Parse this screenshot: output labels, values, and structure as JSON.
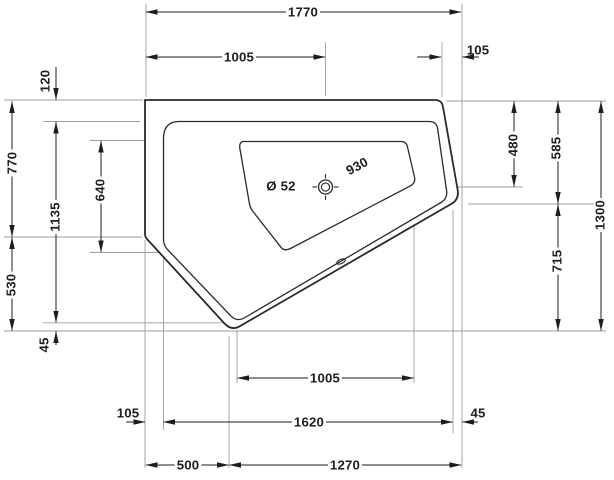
{
  "colors": {
    "line": "#1d1d1b",
    "extension": "#9d9d9d",
    "background": "#ffffff"
  },
  "dimensions": {
    "overall_width": "1770",
    "drain_from_left": "1005",
    "top_right_corner_offset": "105",
    "rim_width_top": "120",
    "left_edge_to_corner": "770",
    "inner_rim_height": "1135",
    "basin_height_left": "640",
    "left_corner_to_vertex": "530",
    "inner_vertex_offset": "45",
    "drain_diameter": "Ø 52",
    "basin_diagonal": "930",
    "drain_from_top": "480",
    "right_edge_to_corner": "585",
    "overall_depth": "1300",
    "right_corner_to_vertex": "715",
    "basin_width_bottom": "1005",
    "inner_rim_width_bottom": "1620",
    "rim_width_left_bottom": "105",
    "rim_width_right_bottom": "45",
    "vertex_from_left": "500",
    "vertex_to_right": "1270"
  }
}
